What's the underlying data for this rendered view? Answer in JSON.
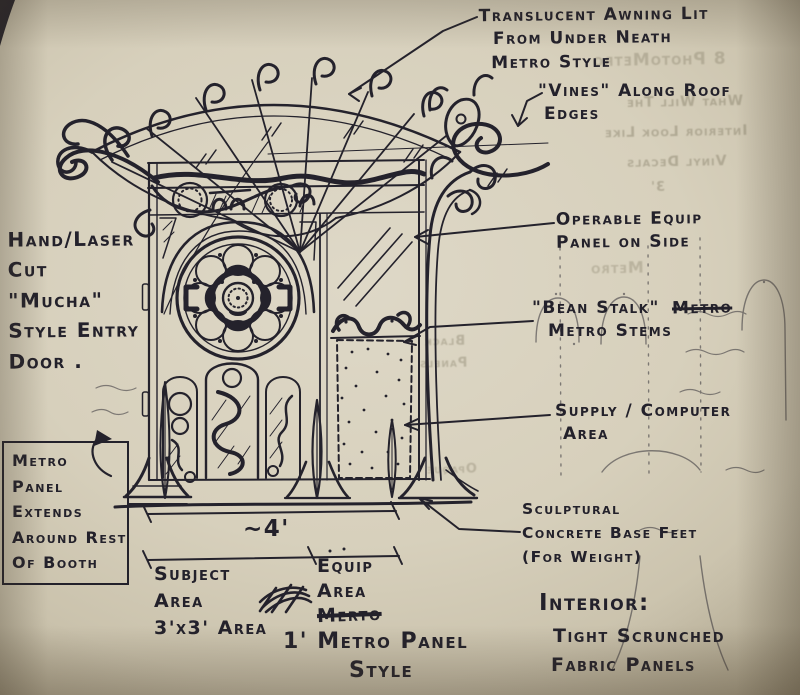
{
  "colors": {
    "ink": "#24222c",
    "paper": "#d7d0bc",
    "paper_edge": "#b0a68c",
    "pencil_ghost": "#98927b"
  },
  "annotations": {
    "awning": {
      "line1": "Translucent Awning Lit",
      "line2": "From Under Neath",
      "line3": "Metro Style"
    },
    "vines": {
      "line1": "\"Vines\" Along Roof",
      "line2": "Edges"
    },
    "equip_panel": {
      "line1": "Operable Equip",
      "line2": "Panel on Side"
    },
    "bean_stalk": {
      "line1": "\"Bean Stalk\"",
      "struck": "Metro",
      "line2": "Metro Stems"
    },
    "supply": {
      "line1": "Supply / Computer",
      "line2": "Area"
    },
    "base_feet": {
      "line1": "Sculptural",
      "line2": "Concrete Base Feet",
      "line3": "(For Weight)"
    },
    "entry_door": {
      "line1": "Hand/Laser",
      "line2": "Cut",
      "line3": "\"Mucha\"",
      "line4": "Style Entry",
      "line5": "Door ."
    },
    "panel_note_box": {
      "line1": "Metro",
      "line2": "Panel",
      "line3": "Extends",
      "line4": "Around Rest",
      "line5": "Of Booth"
    },
    "interior": {
      "line1": "Interior:",
      "line2": "Tight Scrunched",
      "line3": "Fabric Panels"
    }
  },
  "dimensions": {
    "total_width": "~4'",
    "subject_area": {
      "line1": "Subject",
      "line2": "Area",
      "line3": "3'x3' Area"
    },
    "equip_area": {
      "line1": "Equip",
      "line2": "Area",
      "struck": "Merto"
    },
    "panel_style": {
      "line1": "1' Metro Panel",
      "line2": "Style"
    }
  },
  "ghost_bleedthrough": {
    "top1": "8 PhotoMetro",
    "top2": "What Will The",
    "top3": "Interior Look Like",
    "top4": "Vinyl Decals",
    "top5": "3'",
    "mid1": "Metro",
    "mid2": "Black",
    "mid3": "Panels",
    "mid4": "Opaque"
  }
}
